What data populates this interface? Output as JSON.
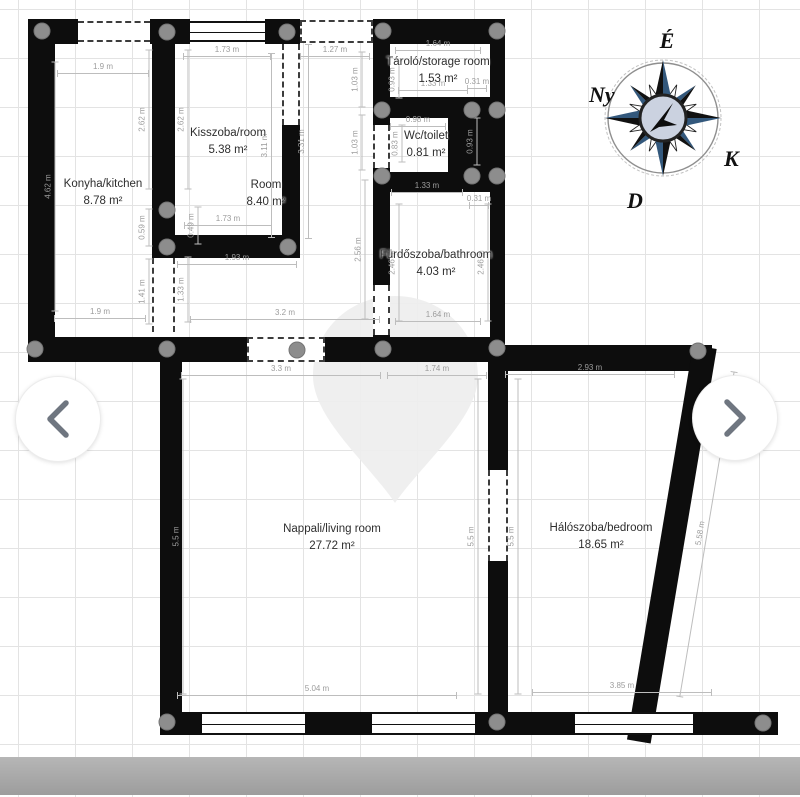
{
  "plan": {
    "rooms": [
      {
        "id": "kitchen",
        "name": "Konyha/kitchen",
        "area": "8.78 m²"
      },
      {
        "id": "kisszoba",
        "name": "Kisszoba/room",
        "area": "5.38 m²"
      },
      {
        "id": "hall-room",
        "name": "Room",
        "area": "8.40 m²"
      },
      {
        "id": "storage",
        "name": "Tároló/storage room",
        "area": "1.53 m²"
      },
      {
        "id": "wc",
        "name": "Wc/toilet",
        "area": "0.81 m²"
      },
      {
        "id": "bathroom",
        "name": "Fürdőszoba/bathroom",
        "area": "4.03 m²"
      },
      {
        "id": "living",
        "name": "Nappali/living room",
        "area": "27.72 m²"
      },
      {
        "id": "bedroom",
        "name": "Hálószoba/bedroom",
        "area": "18.65 m²"
      }
    ],
    "dimensions": [
      {
        "t": "1.9 m",
        "x": 103,
        "y": 74,
        "w": 92,
        "o": "h"
      },
      {
        "t": "1.73 m",
        "x": 227,
        "y": 57,
        "w": 88,
        "o": "h"
      },
      {
        "t": "1.27 m",
        "x": 335,
        "y": 57,
        "w": 70,
        "o": "h"
      },
      {
        "t": "1.64 m",
        "x": 438,
        "y": 51,
        "w": 86,
        "o": "h"
      },
      {
        "t": "1.33 m",
        "x": 433,
        "y": 91,
        "w": 70,
        "o": "h"
      },
      {
        "t": "0.31 m",
        "x": 477,
        "y": 89,
        "w": 20,
        "o": "h"
      },
      {
        "t": "0.98 m",
        "x": 418,
        "y": 127,
        "w": 56,
        "o": "h"
      },
      {
        "t": "1.33 m",
        "x": 427,
        "y": 193,
        "w": 72,
        "o": "h"
      },
      {
        "t": "0.31 m",
        "x": 479,
        "y": 206,
        "w": 20,
        "o": "h"
      },
      {
        "t": "1.73 m",
        "x": 228,
        "y": 226,
        "w": 88,
        "o": "h"
      },
      {
        "t": "1.93 m",
        "x": 237,
        "y": 265,
        "w": 120,
        "o": "h"
      },
      {
        "t": "3.2 m",
        "x": 285,
        "y": 320,
        "w": 190,
        "o": "h"
      },
      {
        "t": "1.9 m",
        "x": 100,
        "y": 319,
        "w": 92,
        "o": "h"
      },
      {
        "t": "1.64 m",
        "x": 438,
        "y": 322,
        "w": 86,
        "o": "h"
      },
      {
        "t": "3.3 m",
        "x": 281,
        "y": 376,
        "w": 200,
        "o": "h"
      },
      {
        "t": "1.74 m",
        "x": 437,
        "y": 376,
        "w": 100,
        "o": "h"
      },
      {
        "t": "2.93 m",
        "x": 590,
        "y": 375,
        "w": 170,
        "o": "h"
      },
      {
        "t": "5.04 m",
        "x": 317,
        "y": 696,
        "w": 280,
        "o": "h"
      },
      {
        "t": "3.85 m",
        "x": 622,
        "y": 693,
        "w": 180,
        "o": "h"
      },
      {
        "t": "4.62 m",
        "x": 50,
        "y": 187,
        "w": 250,
        "o": "v"
      },
      {
        "t": "2.62 m",
        "x": 144,
        "y": 120,
        "w": 140,
        "o": "v"
      },
      {
        "t": "2.62 m",
        "x": 183,
        "y": 120,
        "w": 140,
        "o": "v"
      },
      {
        "t": "3.11 m",
        "x": 266,
        "y": 146,
        "w": 185,
        "o": "v"
      },
      {
        "t": "3.31 m",
        "x": 303,
        "y": 142,
        "w": 195,
        "o": "v"
      },
      {
        "t": "1.03 m",
        "x": 357,
        "y": 80,
        "w": 56,
        "o": "v"
      },
      {
        "t": "1.03 m",
        "x": 357,
        "y": 143,
        "w": 56,
        "o": "v"
      },
      {
        "t": "0.93 m",
        "x": 394,
        "y": 80,
        "w": 38,
        "o": "v"
      },
      {
        "t": "0.83 m",
        "x": 397,
        "y": 144,
        "w": 38,
        "o": "v"
      },
      {
        "t": "0.93 m",
        "x": 472,
        "y": 142,
        "w": 48,
        "o": "v"
      },
      {
        "t": "0.59 m",
        "x": 144,
        "y": 228,
        "w": 38,
        "o": "v"
      },
      {
        "t": "0.49 m",
        "x": 193,
        "y": 226,
        "w": 38,
        "o": "v"
      },
      {
        "t": "1.41 m",
        "x": 144,
        "y": 292,
        "w": 66,
        "o": "v"
      },
      {
        "t": "1.33 m",
        "x": 183,
        "y": 290,
        "w": 66,
        "o": "v"
      },
      {
        "t": "2.56 m",
        "x": 360,
        "y": 250,
        "w": 140,
        "o": "v"
      },
      {
        "t": "2.46 m",
        "x": 394,
        "y": 263,
        "w": 118,
        "o": "v"
      },
      {
        "t": "2.46 m",
        "x": 483,
        "y": 263,
        "w": 118,
        "o": "v"
      },
      {
        "t": "5.5 m",
        "x": 178,
        "y": 537,
        "w": 316,
        "o": "v"
      },
      {
        "t": "5.5 m",
        "x": 473,
        "y": 537,
        "w": 316,
        "o": "v"
      },
      {
        "t": "5.5 m",
        "x": 513,
        "y": 537,
        "w": 316,
        "o": "v"
      },
      {
        "t": "5.58 m",
        "x": 702,
        "y": 534,
        "w": 330,
        "o": "v",
        "r": -80.5
      }
    ],
    "handles": [
      [
        42,
        31
      ],
      [
        167,
        32
      ],
      [
        287,
        32
      ],
      [
        383,
        31
      ],
      [
        497,
        31
      ],
      [
        382,
        110
      ],
      [
        472,
        110
      ],
      [
        497,
        110
      ],
      [
        382,
        176
      ],
      [
        472,
        176
      ],
      [
        497,
        176
      ],
      [
        167,
        210
      ],
      [
        167,
        247
      ],
      [
        288,
        247
      ],
      [
        35,
        349
      ],
      [
        167,
        349
      ],
      [
        297,
        350
      ],
      [
        383,
        349
      ],
      [
        497,
        348
      ],
      [
        698,
        351
      ],
      [
        167,
        722
      ],
      [
        497,
        722
      ],
      [
        763,
        723
      ]
    ],
    "compass": {
      "north": "É",
      "west": "Ny",
      "east": "K",
      "south": "D",
      "colors": {
        "point_dark": "#111111",
        "point_navy": "#33587c",
        "center_fill": "#cbd2e0"
      }
    },
    "colors": {
      "wall": "#0d0d0d",
      "dimension_text": "#9c9c9c",
      "handle": "#8d8d8d",
      "bottom_bar": "#a6a6a6"
    }
  },
  "carousel": {
    "prev_label": "previous image",
    "next_label": "next image"
  }
}
